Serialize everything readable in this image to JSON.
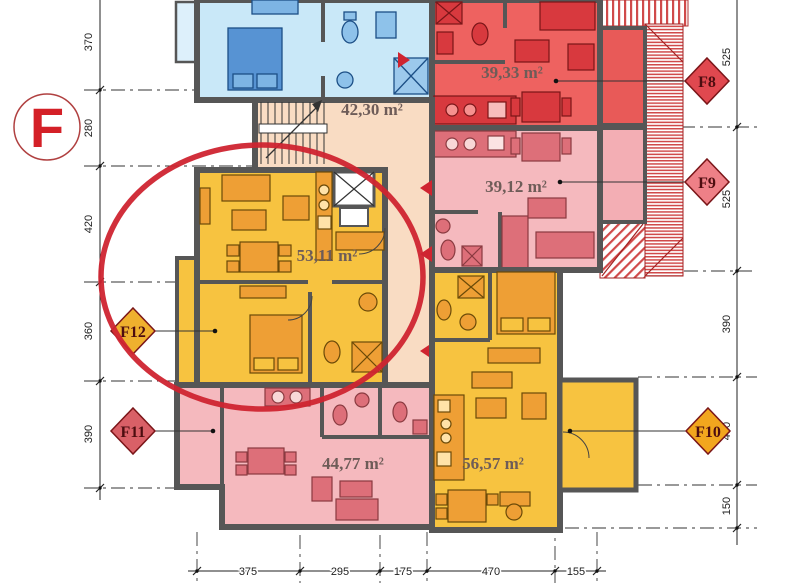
{
  "logo": {
    "letter": "F"
  },
  "units": [
    {
      "name": "stairwell",
      "area_label": "42,30 m²"
    },
    {
      "name": "apartment-f8",
      "area_label": "39,33 m²"
    },
    {
      "name": "apartment-f9",
      "area_label": "39,12 m²"
    },
    {
      "name": "apartment-f12",
      "area_label": "53,11 m²",
      "highlighted": true
    },
    {
      "name": "apartment-f11",
      "area_label": "44,77 m²"
    },
    {
      "name": "apartment-f10",
      "area_label": "56,57 m²"
    }
  ],
  "markers": [
    {
      "label": "F8",
      "color": "#e0484f"
    },
    {
      "label": "F9",
      "color": "#ee8087"
    },
    {
      "label": "F10",
      "color": "#f2a61e"
    },
    {
      "label": "F11",
      "color": "#d96067"
    },
    {
      "label": "F12",
      "color": "#efb02e"
    }
  ],
  "dimensions": {
    "left": [
      "370",
      "280",
      "420",
      "360",
      "390"
    ],
    "right": [
      "525",
      "525",
      "390",
      "400",
      "150"
    ],
    "bottom": [
      "375",
      "295",
      "175",
      "470",
      "155"
    ]
  },
  "colors": {
    "wall": "#565656",
    "room_blue": "#c9e8f8",
    "room_red": "#ee6260",
    "room_pink": "#f5b9be",
    "room_peach": "#f9dcc3",
    "room_gold": "#f7c340",
    "balcony_red": "#e85a58",
    "balcony_pink": "#f3aeb4",
    "highlight": "#cf2430",
    "logo": "#d42027",
    "area_label": "#6e5c58",
    "roof_stripe": "#d04a4a"
  }
}
